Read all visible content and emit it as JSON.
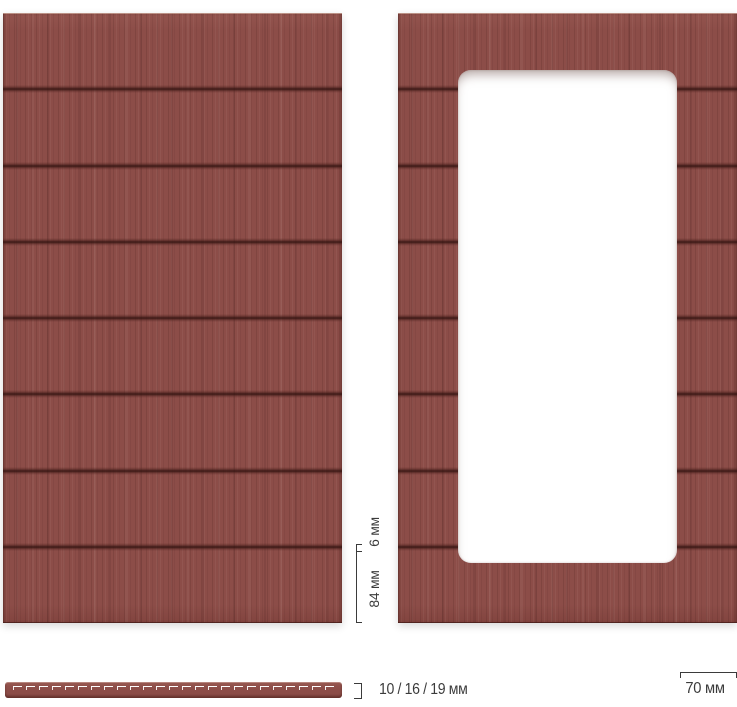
{
  "diagram": {
    "description_colors": {
      "panel_base": "#8c4d48",
      "groove_dark": "#30110e",
      "window": "#ffffff",
      "dimension_ink": "#3b3b3b",
      "background": "#ffffff"
    },
    "panels": {
      "left": {
        "type": "solid-milled-facade",
        "plank_count": 8
      },
      "right": {
        "type": "milled-facade-with-glass-window",
        "plank_count": 8
      }
    },
    "dimensions": {
      "groove_width": "6 мм",
      "plank_height": "84 мм",
      "thickness_options": "10 / 16 / 19 мм",
      "frame_width": "70 мм"
    }
  }
}
